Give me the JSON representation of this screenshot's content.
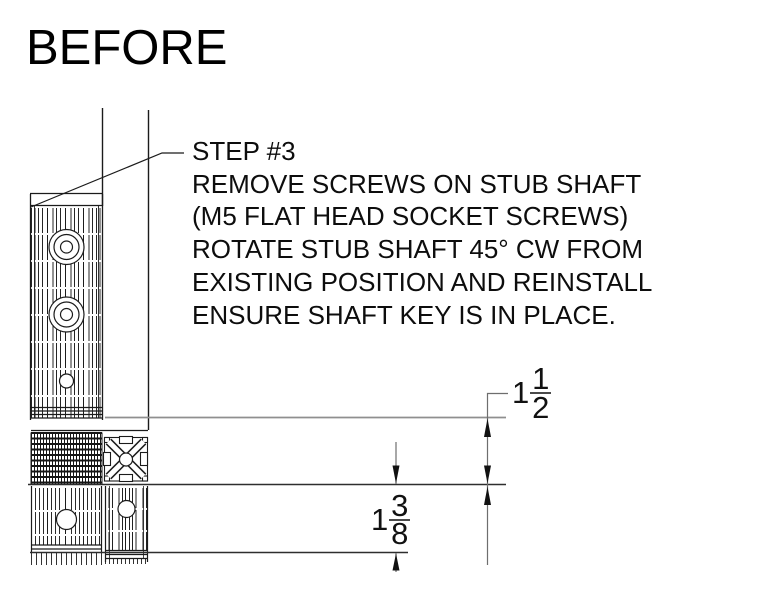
{
  "title": "BEFORE",
  "note": {
    "lines": [
      "STEP #3",
      "REMOVE SCREWS ON STUB SHAFT",
      "(M5 FLAT HEAD SOCKET SCREWS)",
      "ROTATE STUB SHAFT 45° CW FROM",
      "EXISTING POSITION AND REINSTALL",
      "ENSURE SHAFT KEY IS IN PLACE."
    ]
  },
  "dimensions": {
    "vertical_upper": {
      "whole": "1",
      "numerator": "1",
      "denominator": "2"
    },
    "vertical_lower": {
      "whole": "1",
      "numerator": "3",
      "denominator": "8"
    }
  },
  "colors": {
    "object_line": "#1b1b1b",
    "dimension_line": "#6e6e6e",
    "extension_line": "#8f8f8f",
    "text": "#111111",
    "background": "#ffffff"
  }
}
